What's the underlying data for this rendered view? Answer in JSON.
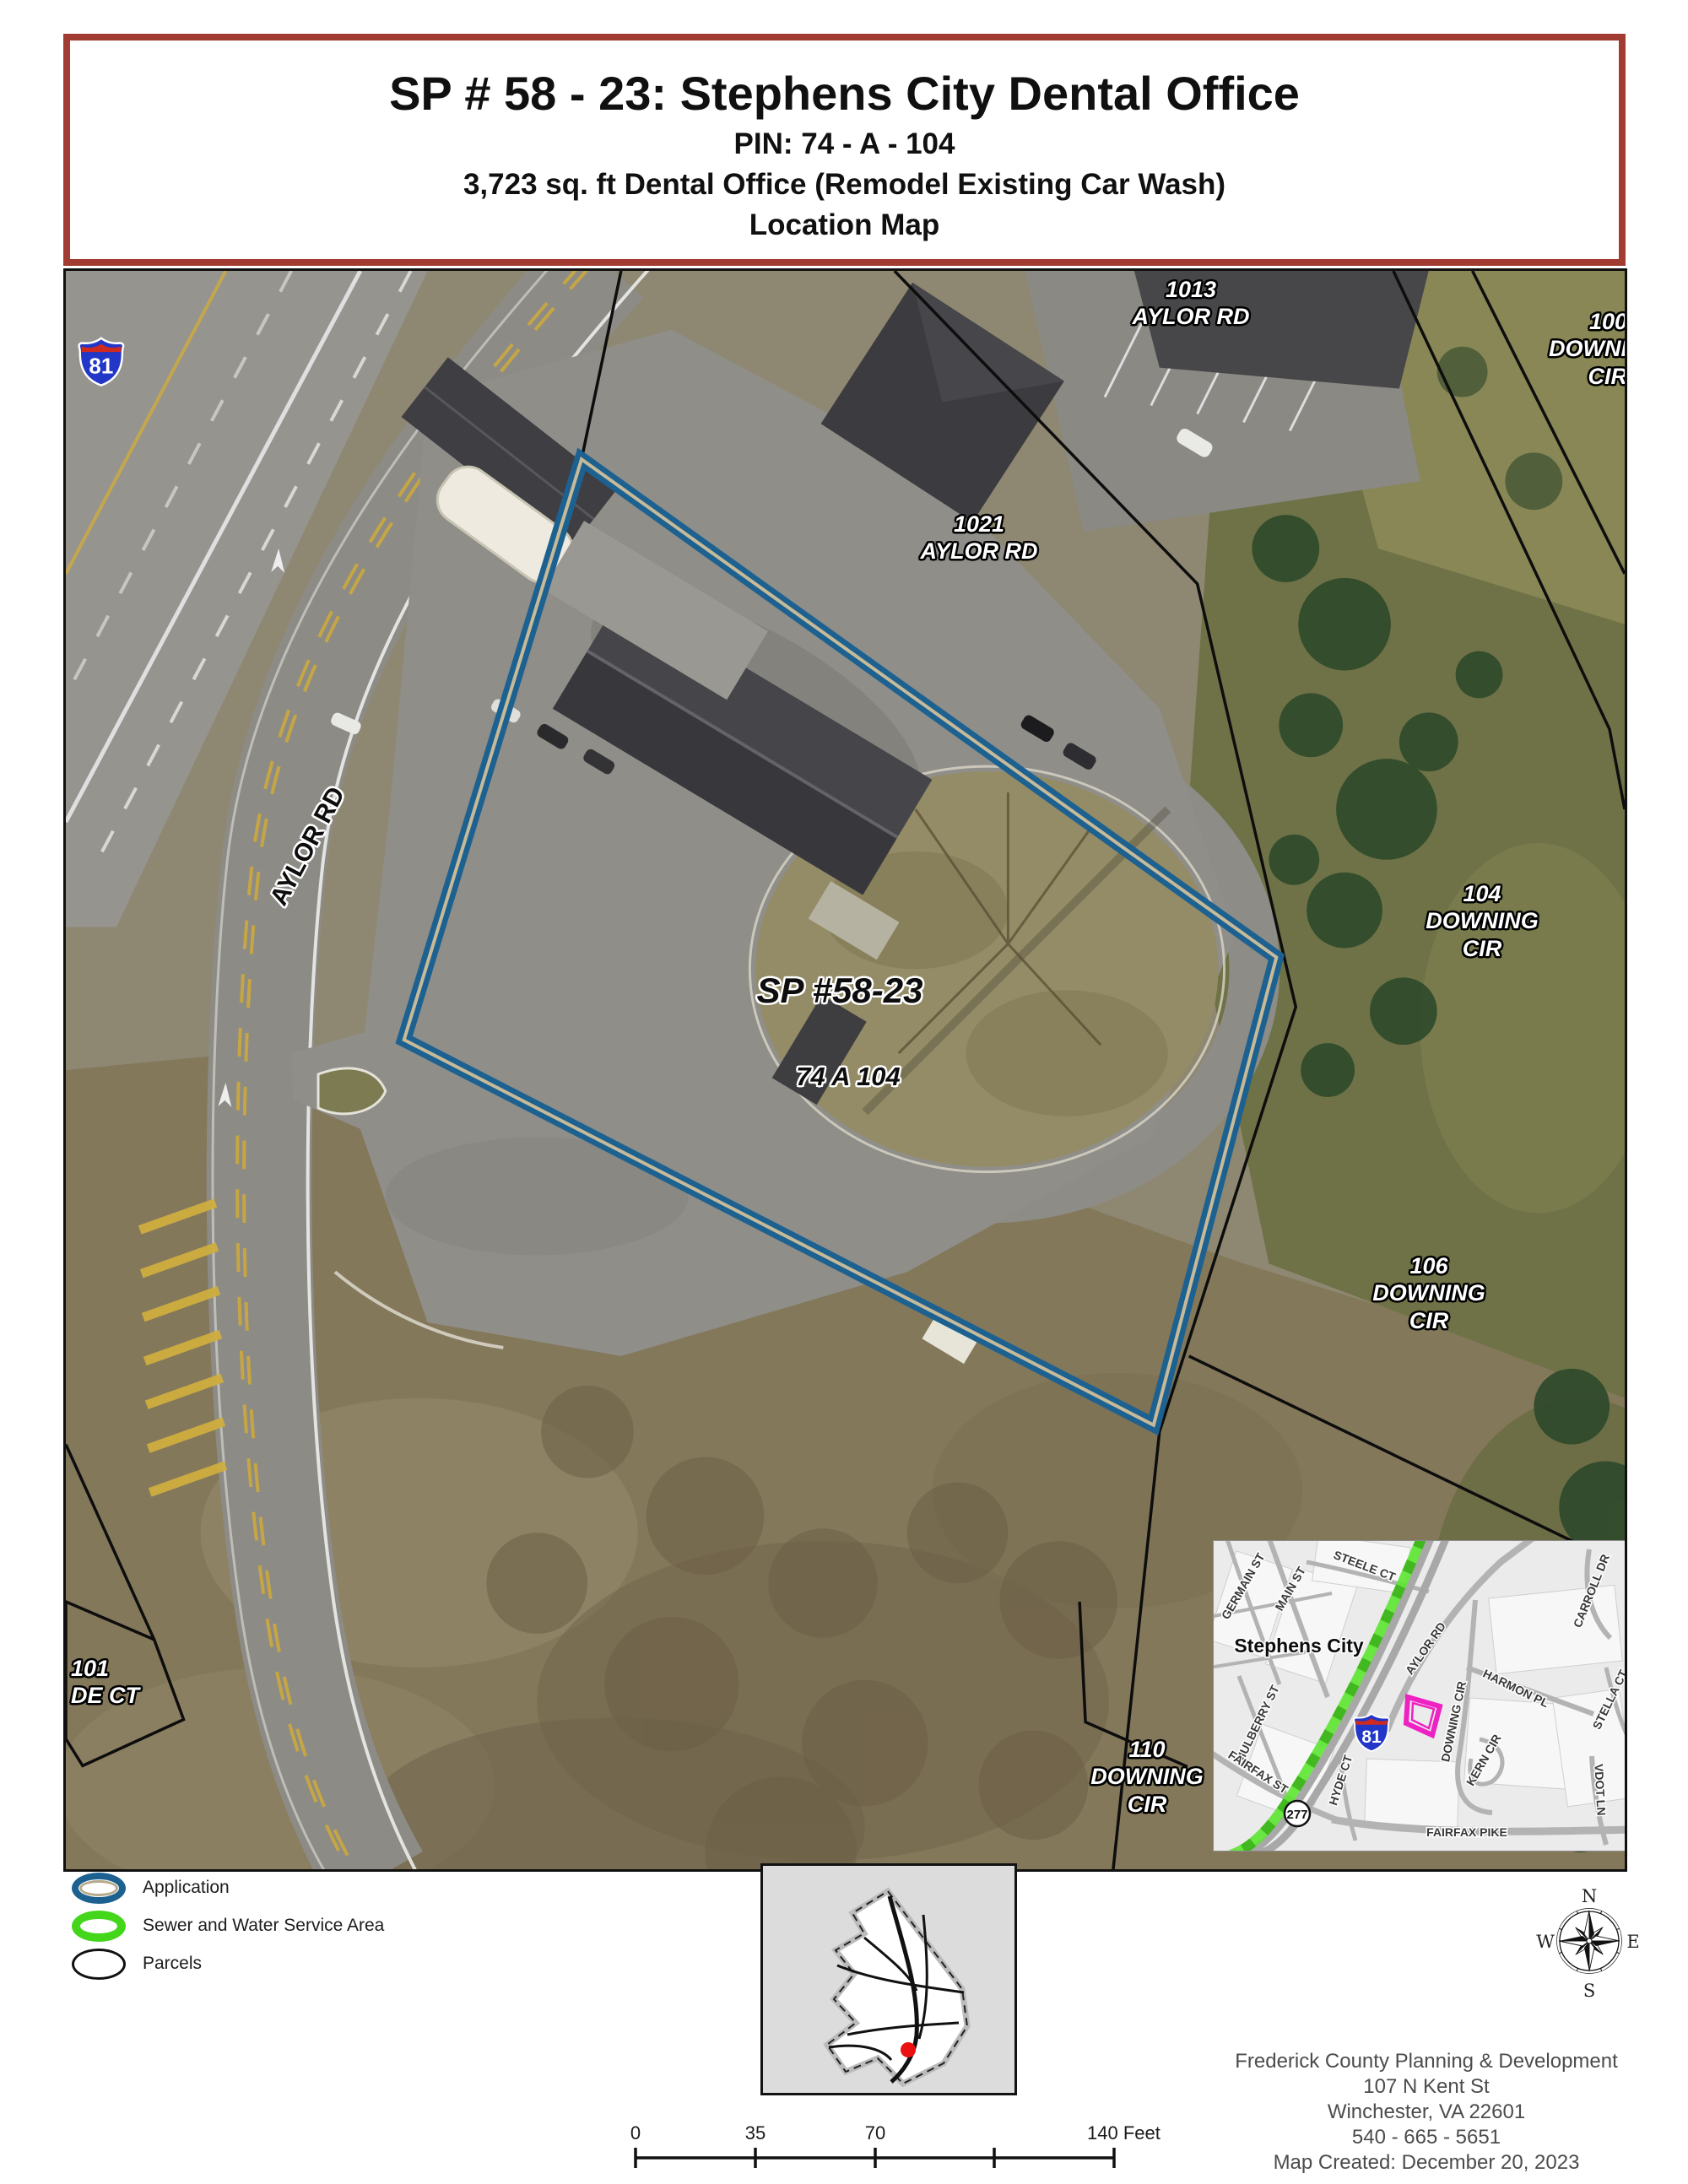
{
  "title_block": {
    "line1": "SP # 58 - 23: Stephens City Dental Office",
    "line2": "PIN: 74 - A - 104",
    "line3": "3,723 sq. ft Dental Office (Remodel Existing Car Wash)",
    "line4": "Location Map"
  },
  "aerial": {
    "interstate_shield": "81",
    "labels": {
      "p1013": "1013\nAYLOR RD",
      "p100": "100\nDOWNI\nCIR",
      "p1021": "1021\nAYLOR RD",
      "site_case": "SP #58-23",
      "site_pin": "74 A 104",
      "p104": "104\nDOWNING\nCIR",
      "p106": "106\nDOWNING\nCIR",
      "p110": "110\nDOWNING\nCIR",
      "p101": "101\nDE CT",
      "aylor_rd": "AYLOR RD"
    }
  },
  "inset": {
    "city": "Stephens City",
    "interstate_shield": "81",
    "route_shield": "277",
    "streets": [
      "GERMAIN ST",
      "MAIN ST",
      "STEELE CT",
      "CARROLL DR",
      "AYLOR RD",
      "HARMON PL",
      "DOWNING CIR",
      "STELLA CT",
      "MULBERRY ST",
      "KERN CIR",
      "VDOT LN",
      "FAIRFAX ST",
      "HYDE CT",
      "FAIRFAX PIKE"
    ]
  },
  "legend": {
    "application": "Application",
    "sewer": "Sewer and Water Service Area",
    "parcels": "Parcels"
  },
  "scalebar": {
    "t0": "0",
    "t35": "35",
    "t70": "70",
    "t140": "140 Feet"
  },
  "compass": {
    "n": "N",
    "e": "E",
    "s": "S",
    "w": "W"
  },
  "credits": {
    "org": "Frederick County Planning & Development",
    "address": "107 N Kent St",
    "city": "Winchester, VA 22601",
    "phone": "540 - 665 - 5651",
    "created": "Map Created: December 20, 2023"
  },
  "colors": {
    "title_border": "#a23b31",
    "application_outline": "#1d6191",
    "application_inner_line": "#c6ba99",
    "sewer_green": "#43d61b",
    "parcels_black": "#111111",
    "site_highlight_magenta": "#ee22c3",
    "interstate_blue": "#2237c8",
    "interstate_red": "#cf2a20",
    "county_location_dot": "#ec1111"
  }
}
